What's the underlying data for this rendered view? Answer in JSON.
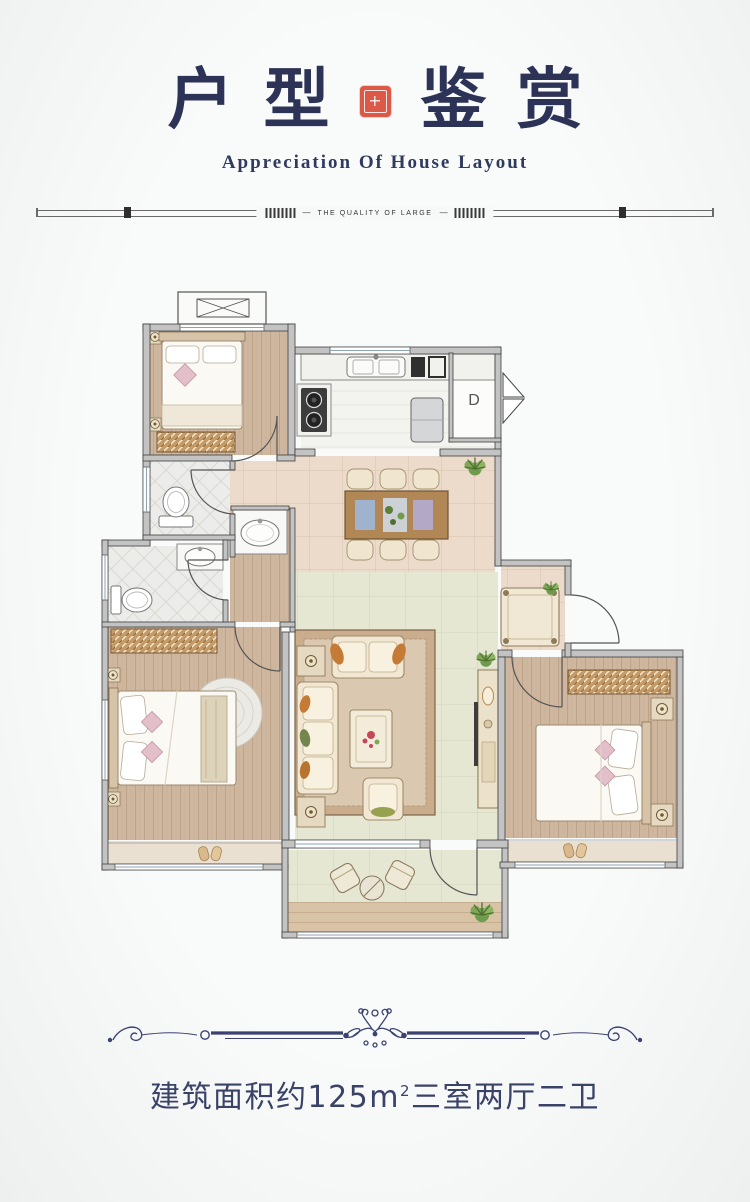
{
  "header": {
    "title_char_1": "户",
    "title_char_2": "型",
    "title_char_3": "鉴",
    "title_char_4": "赏",
    "subtitle": "Appreciation Of House Layout",
    "divider_text": "THE QUALITY OF LARGE",
    "seal_color": "#dc5947",
    "title_color": "#2c3356"
  },
  "floorplan": {
    "duct_label": "D",
    "rooms": [
      "bedroom-top-left",
      "kitchen",
      "duct-room",
      "dining-area",
      "entry-hall",
      "living-room",
      "bathroom-1",
      "bathroom-2",
      "master-bedroom",
      "bedroom-right",
      "balcony"
    ],
    "colors": {
      "wood_floor": "#cfb79f",
      "dining_tile": "#ecdbcb",
      "living_tile": "#e6e7d3",
      "bath_tile": "#ececea",
      "wall": "#c3c3c3",
      "wardrobe": "#c49a66"
    }
  },
  "footer": {
    "area_prefix": "建筑面积约125m",
    "area_sup": "2",
    "area_suffix": "三室两厅二卫",
    "text_color": "#3a4268"
  }
}
